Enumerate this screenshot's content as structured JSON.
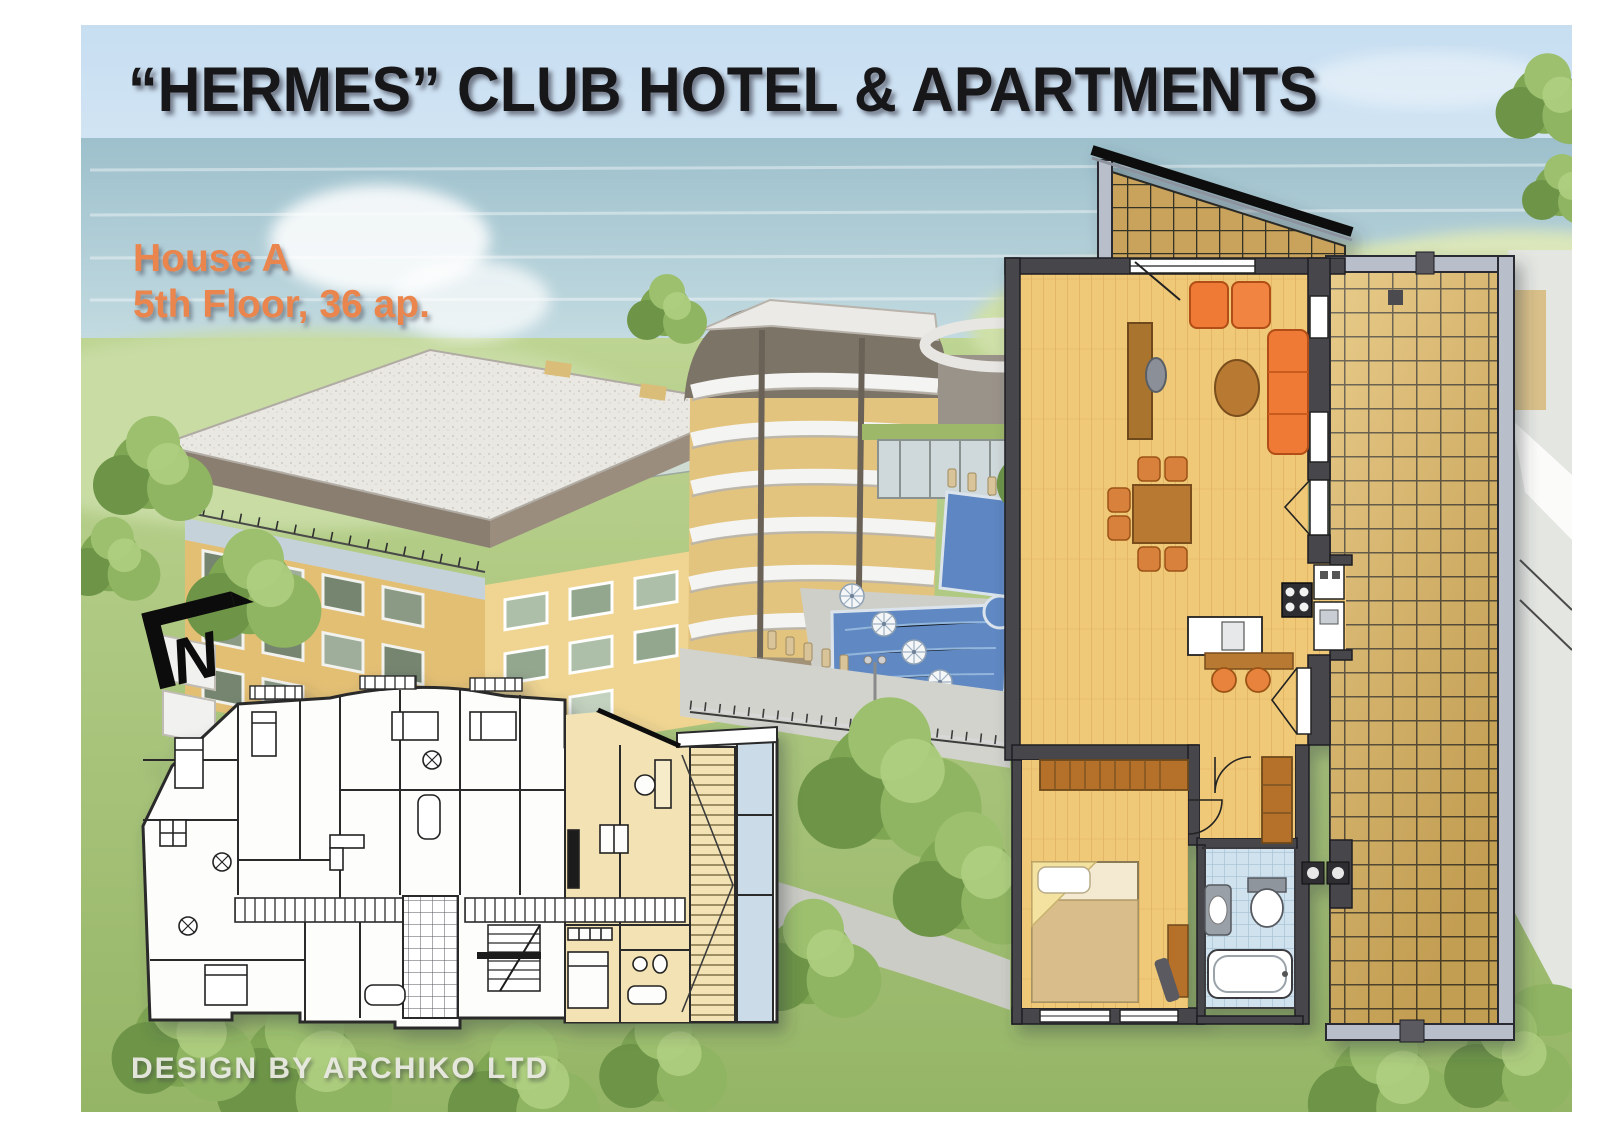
{
  "header": {
    "title": "“HERMES” CLUB HOTEL & APARTMENTS"
  },
  "annotation": {
    "house": "House A",
    "floor": "5th Floor, 36 ap."
  },
  "footer": {
    "credit": "DESIGN BY ARCHIKO LTD"
  },
  "icons": {
    "north_arrow": "N"
  },
  "colors": {
    "title_text": "#17171a",
    "accent_orange": "#e9854d",
    "credit_text": "#ebebe5",
    "sky_blue": "#c7def1",
    "sea_blue": "#a3c6d1",
    "grass_green": "#a6c277",
    "building_yellow": "#eac87e",
    "roof_gray": "#8a7e70",
    "pool_blue": "#6089c4",
    "plan_highlight_yellow": "#f3e3b4",
    "wood_floor": "#efc977",
    "terrace_tile": "#e0ba68",
    "sofa_orange": "#ee7a35",
    "plan_wall_gray": "#46464c",
    "bath_tile_blue": "#cfe2ee"
  }
}
